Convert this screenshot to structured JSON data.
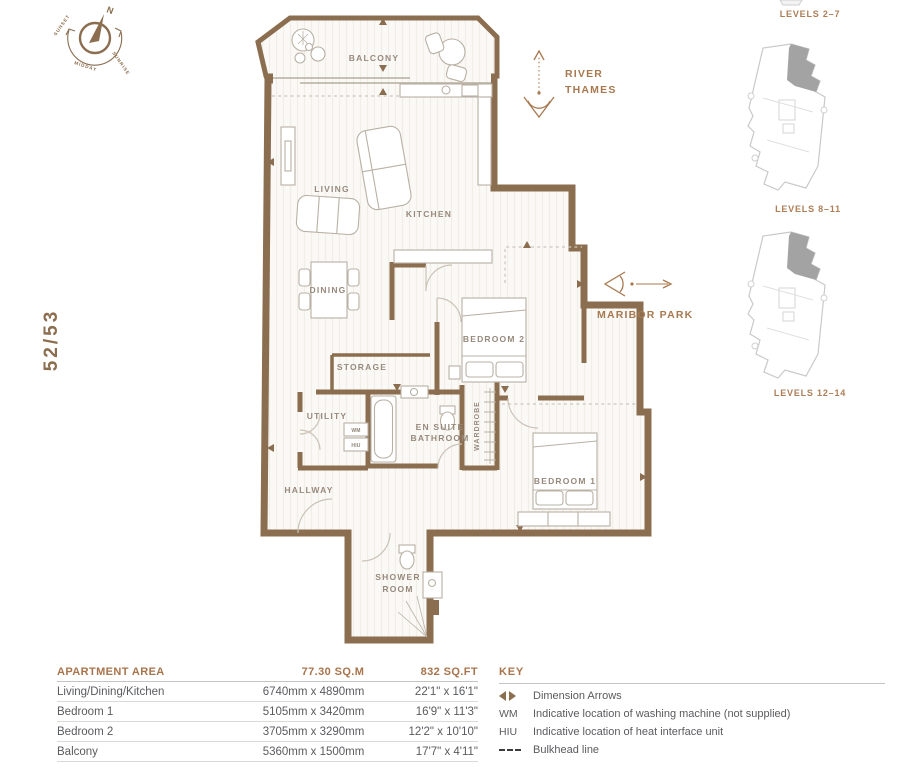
{
  "unit": {
    "number": "52/53"
  },
  "compass": {
    "n": "N",
    "sunset": "SUNSET",
    "midday": "MIDDAY",
    "sunrise": "SUNRISE"
  },
  "orientation": {
    "river_line1": "RIVER",
    "river_line2": "THAMES",
    "park": "MARIBOR PARK"
  },
  "rooms": {
    "balcony": "BALCONY",
    "living": "LIVING",
    "kitchen": "KITCHEN",
    "dining": "DINING",
    "storage": "STORAGE",
    "utility": "UTILITY",
    "ensuite1": "EN SUITE",
    "ensuite2": "BATHROOM",
    "wardrobe": "WARDROBE",
    "bedroom2": "BEDROOM 2",
    "bedroom1": "BEDROOM 1",
    "hallway": "HALLWAY",
    "shower1": "SHOWER",
    "shower2": "ROOM",
    "wm": "WM",
    "hiu": "HIU"
  },
  "levels": {
    "l1": "LEVELS 2–7",
    "l2": "LEVELS 8–11",
    "l3": "LEVELS 12–14"
  },
  "area_table": {
    "headers": [
      "APARTMENT AREA",
      "77.30 SQ.M",
      "832 SQ.FT"
    ],
    "rows": [
      [
        "Living/Dining/Kitchen",
        "6740mm x 4890mm",
        "22'1\" x 16'1\""
      ],
      [
        "Bedroom 1",
        "5105mm x 3420mm",
        "16'9\" x 11'3\""
      ],
      [
        "Bedroom 2",
        "3705mm x 3290mm",
        "12'2\" x 10'10\""
      ],
      [
        "Balcony",
        "5360mm x 1500mm",
        "17'7\" x 4'11\""
      ]
    ]
  },
  "key": {
    "title": "KEY",
    "items": [
      {
        "symbol": "",
        "label": "Dimension Arrows"
      },
      {
        "symbol": "WM",
        "label": "Indicative location of washing machine (not supplied)"
      },
      {
        "symbol": "HIU",
        "label": "Indicative location of heat interface unit"
      },
      {
        "symbol": "",
        "label": "Bulkhead line"
      }
    ]
  },
  "colors": {
    "wall": "#8b6d4f",
    "accent": "#a8744c",
    "text": "#5a5b5e"
  }
}
